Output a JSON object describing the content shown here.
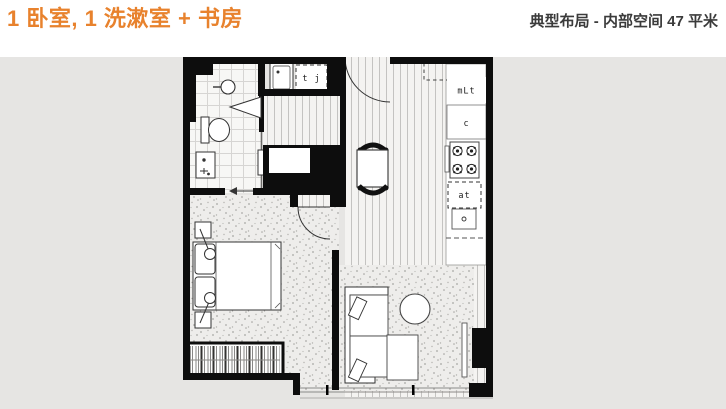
{
  "header": {
    "title": "1 卧室, 1 洗漱室 + 书房",
    "subtitle": "典型布局 - 内部空间 47 平米"
  },
  "colors": {
    "accent_orange": "#E8822D",
    "subtitle_dark": "#3B3B3B",
    "panel_gray": "#E6E5E3",
    "wall_black": "#0D0D0D"
  },
  "floorplan": {
    "labels": {
      "laundry_box": "t j",
      "kitchen_top_box": "mLt",
      "kitchen_mid_box": "c",
      "kitchen_low_box": "at"
    }
  }
}
